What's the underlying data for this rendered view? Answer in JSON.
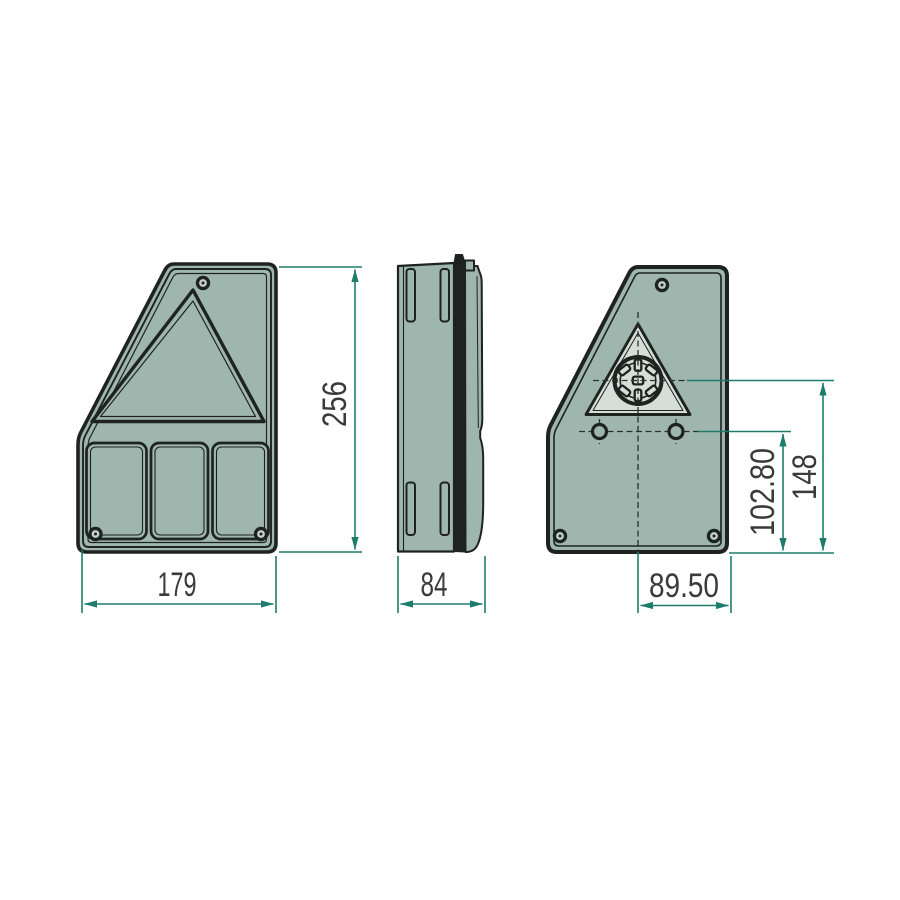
{
  "colors": {
    "background": "#ffffff",
    "housing_fill": "#9eb6ae",
    "panel_light_fill": "#d6ded8",
    "screw_inner_fill": "#c2d1cb",
    "outline": "#1e2321",
    "dimension_line": "#1e7c6d",
    "dimension_text": "#3a3a3a"
  },
  "dimensions": {
    "front_width": "179",
    "front_height": "256",
    "side_depth": "84",
    "connector_to_right_edge": "89.50",
    "holes_to_bottom": "102.80",
    "connector_to_bottom": "148"
  }
}
